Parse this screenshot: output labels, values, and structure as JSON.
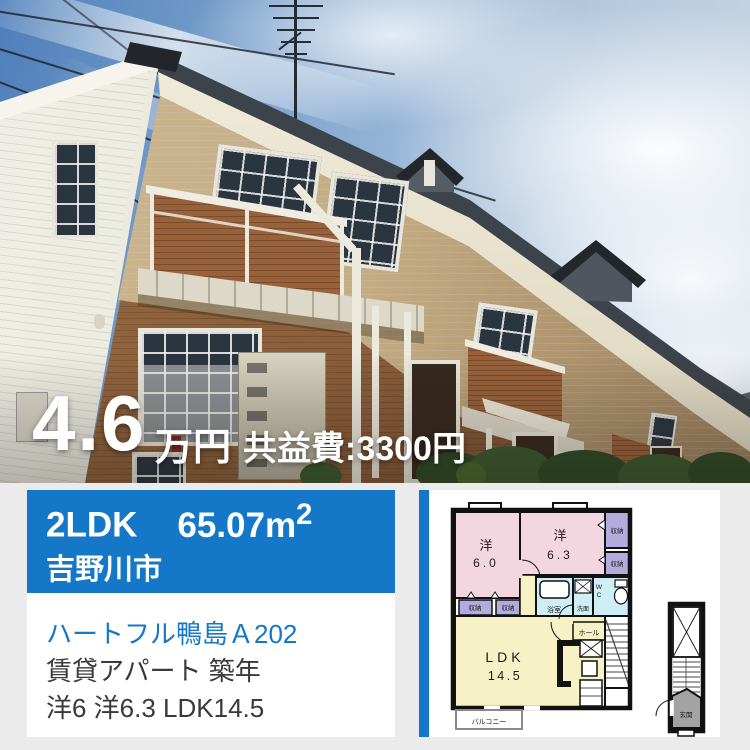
{
  "photo": {
    "price_value": "4.6",
    "price_unit": "万円",
    "fee": "共益費:3300円"
  },
  "summary": {
    "layout": "2LDK",
    "area": "65.07m",
    "area_sup": "2",
    "city": "吉野川市"
  },
  "details": {
    "title": "ハートフル鴨島Ａ202",
    "category_line": "賃貸アパート 築年",
    "rooms_line": "洋6 洋6.3 LDK14.5"
  },
  "floorplan": {
    "labels": {
      "west1_name": "洋",
      "west1_size": "6.0",
      "west2_name": "洋",
      "west2_size": "6.3",
      "closet": "収納",
      "bath": "浴室",
      "wash": "洗面",
      "wc_w": "W",
      "wc_c": "C",
      "hall": "ホール",
      "ldk_name": "LDK",
      "ldk_size": "14.5",
      "balcony": "バルコニー",
      "entrance": "玄関"
    }
  },
  "colors": {
    "accent_blue": "#1577c8",
    "background_gray": "#ebebeb",
    "plan_pink": "#f4d6e0",
    "plan_purple": "#b4abdd",
    "plan_light_blue": "#cdeef5",
    "plan_yellow": "#f7f2c6",
    "plan_entrance_gray": "#a3a3a3"
  }
}
